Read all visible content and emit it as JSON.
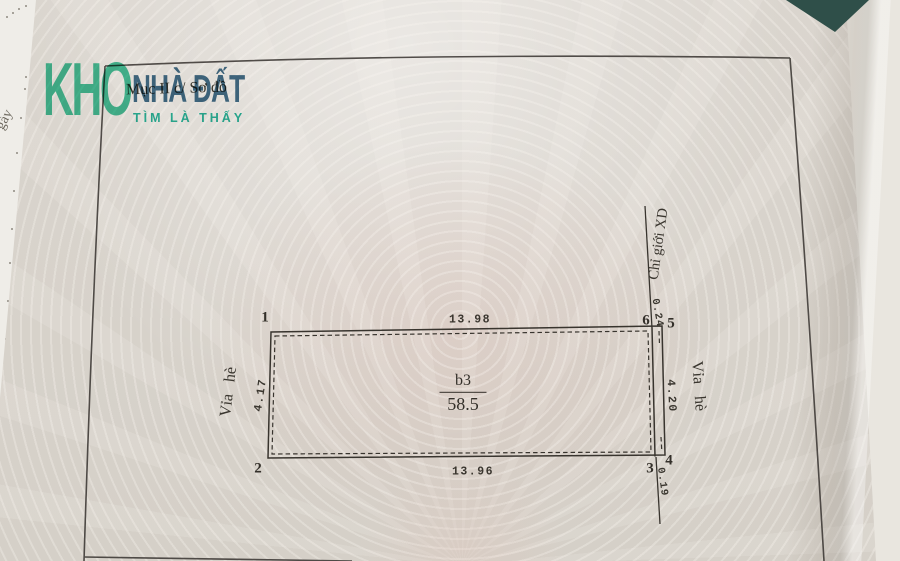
{
  "watermark": {
    "brand_top": "KHO",
    "brand_main": "NHÀ ĐẤT",
    "brand_tagline": "TÌM LÀ THẤY",
    "color_green": "#49c6a0",
    "color_blue": "#44708e",
    "color_teal": "#2cbaa2"
  },
  "document": {
    "section_title": "Mục II c/ Sơ đồ",
    "underlying_text_fragment": "gày"
  },
  "plot": {
    "parcel_label": "b3",
    "parcel_area": "58.5",
    "dim_top": "13.98",
    "dim_bottom": "13.96",
    "dim_left": "4.17",
    "dim_right": "4.20",
    "strip_width_top": "0.24",
    "strip_width_bottom": "0.19",
    "sidewalk_left": "Vỉa hè",
    "sidewalk_right": "Vỉa hè",
    "construction_boundary": "Chỉ giới XD",
    "ink_color": "#38342e",
    "points": {
      "p1": "1",
      "p2": "2",
      "p3": "3",
      "p4": "4",
      "p5": "5",
      "p6": "6"
    }
  }
}
